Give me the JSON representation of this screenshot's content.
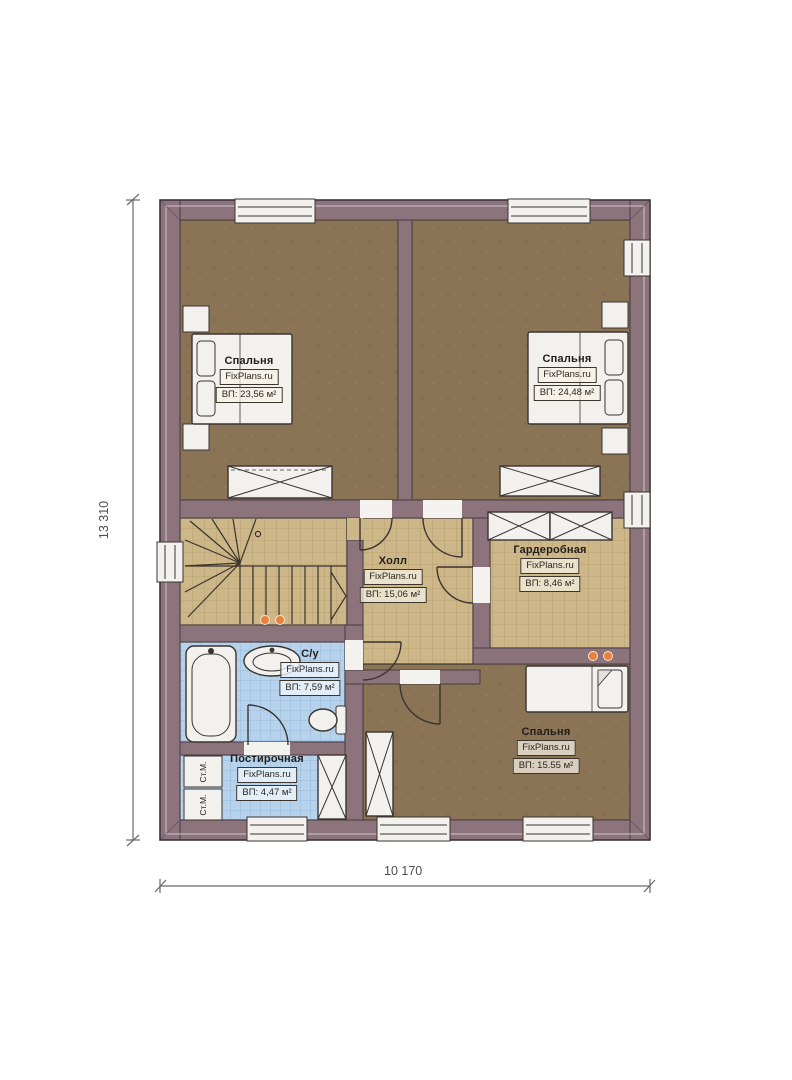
{
  "watermark": "FixPlans.ru",
  "dimensions": {
    "vertical": "13 310",
    "horizontal": "10 170"
  },
  "rooms": [
    {
      "key": "bedroom-top-left",
      "name": "Спальня",
      "area": "ВП: 23,56 м²"
    },
    {
      "key": "bedroom-top-right",
      "name": "Спальня",
      "area": "ВП: 24,48 м²"
    },
    {
      "key": "hall",
      "name": "Холл",
      "area": "ВП: 15,06 м²"
    },
    {
      "key": "wardrobe",
      "name": "Гардеробная",
      "area": "ВП: 8,46 м²"
    },
    {
      "key": "bathroom",
      "name": "С/у",
      "area": "ВП: 7,59 м²"
    },
    {
      "key": "laundry",
      "name": "Постирочная",
      "area": "ВП: 4,47 м²"
    },
    {
      "key": "bedroom-bottom",
      "name": "Спальня",
      "area": "ВП: 15.55 м²"
    }
  ],
  "appliances": {
    "washer": "Ст.М."
  },
  "colors": {
    "wall": "#8d747c",
    "wall_line": "#463d43",
    "bedroom_floor": "#8b7355",
    "tile_floor": "#cdb687",
    "tile_line": "#b29c6e",
    "wet_floor": "#b7d3ec",
    "wet_line": "#8db2d6",
    "fixture": "#f2f1ee",
    "outline": "#3a3430",
    "accent_dot": "#e8813c",
    "dim": "#4f4c4c"
  }
}
